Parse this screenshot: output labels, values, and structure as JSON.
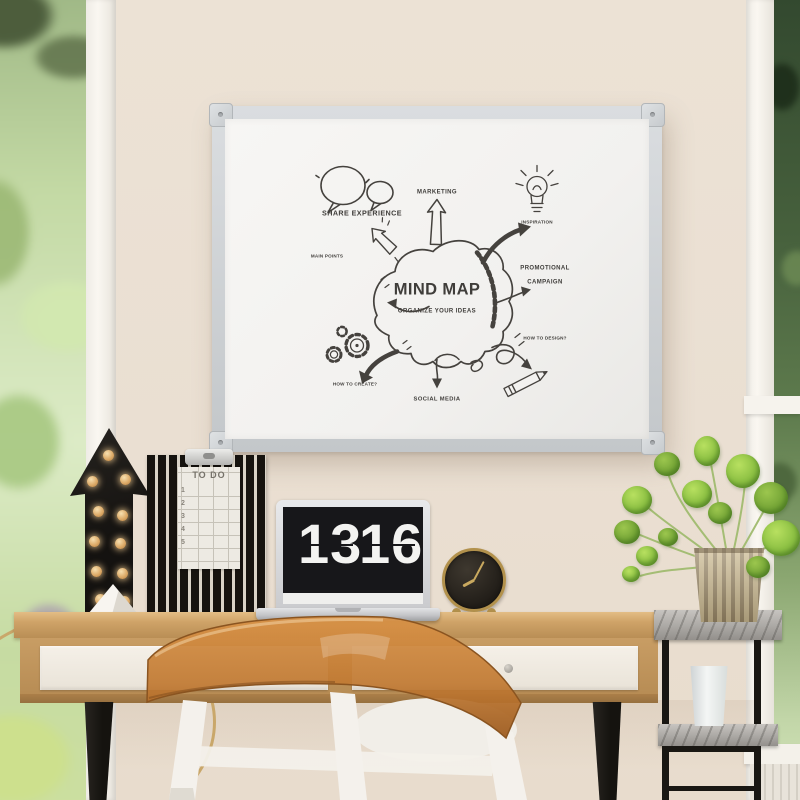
{
  "whiteboard": {
    "title": "MIND MAP",
    "subtitle": "ORGANIZE YOUR IDEAS",
    "labels": {
      "share_experience": "SHARE EXPERIENCE",
      "marketing": "MARKETING",
      "inspiration": "INSPIRATION",
      "promotional_line1": "PROMOTIONAL",
      "promotional_line2": "CAMPAIGN",
      "main_points": "MAIN POINTS",
      "how_to_create": "HOW TO CREATE?",
      "how_to_design": "HOW TO DESIGN?",
      "social_media": "SOCIAL MEDIA"
    }
  },
  "desk": {
    "flip_clock": {
      "hours": "13",
      "minutes": "16"
    },
    "todo_list": {
      "title": "TO DO",
      "rows": [
        "1",
        "2",
        "3",
        "4",
        "5"
      ]
    }
  },
  "colors": {
    "wall": "#eadfd2",
    "board_frame": "#c9cdd0",
    "board_surface": "#f4f3f1",
    "marker_ink": "#45423e",
    "desk_wood": "#c89d64",
    "drawer_front": "#f3eee6",
    "leg_black": "#1b1915",
    "chair_amber": "#c9803c",
    "chair_white": "#f4f1ec",
    "marquee_black": "#17140f",
    "bulb_amber": "#e8b87e",
    "laptop_silver": "#d3d4d6",
    "clock_gold": "#b2914c",
    "plant_green": "#8cc043",
    "pot_gold": "#b5a27c",
    "marble_gray": "#aba8a4",
    "foliage_left": "#c3d9a4",
    "foliage_right": "#47613d"
  }
}
